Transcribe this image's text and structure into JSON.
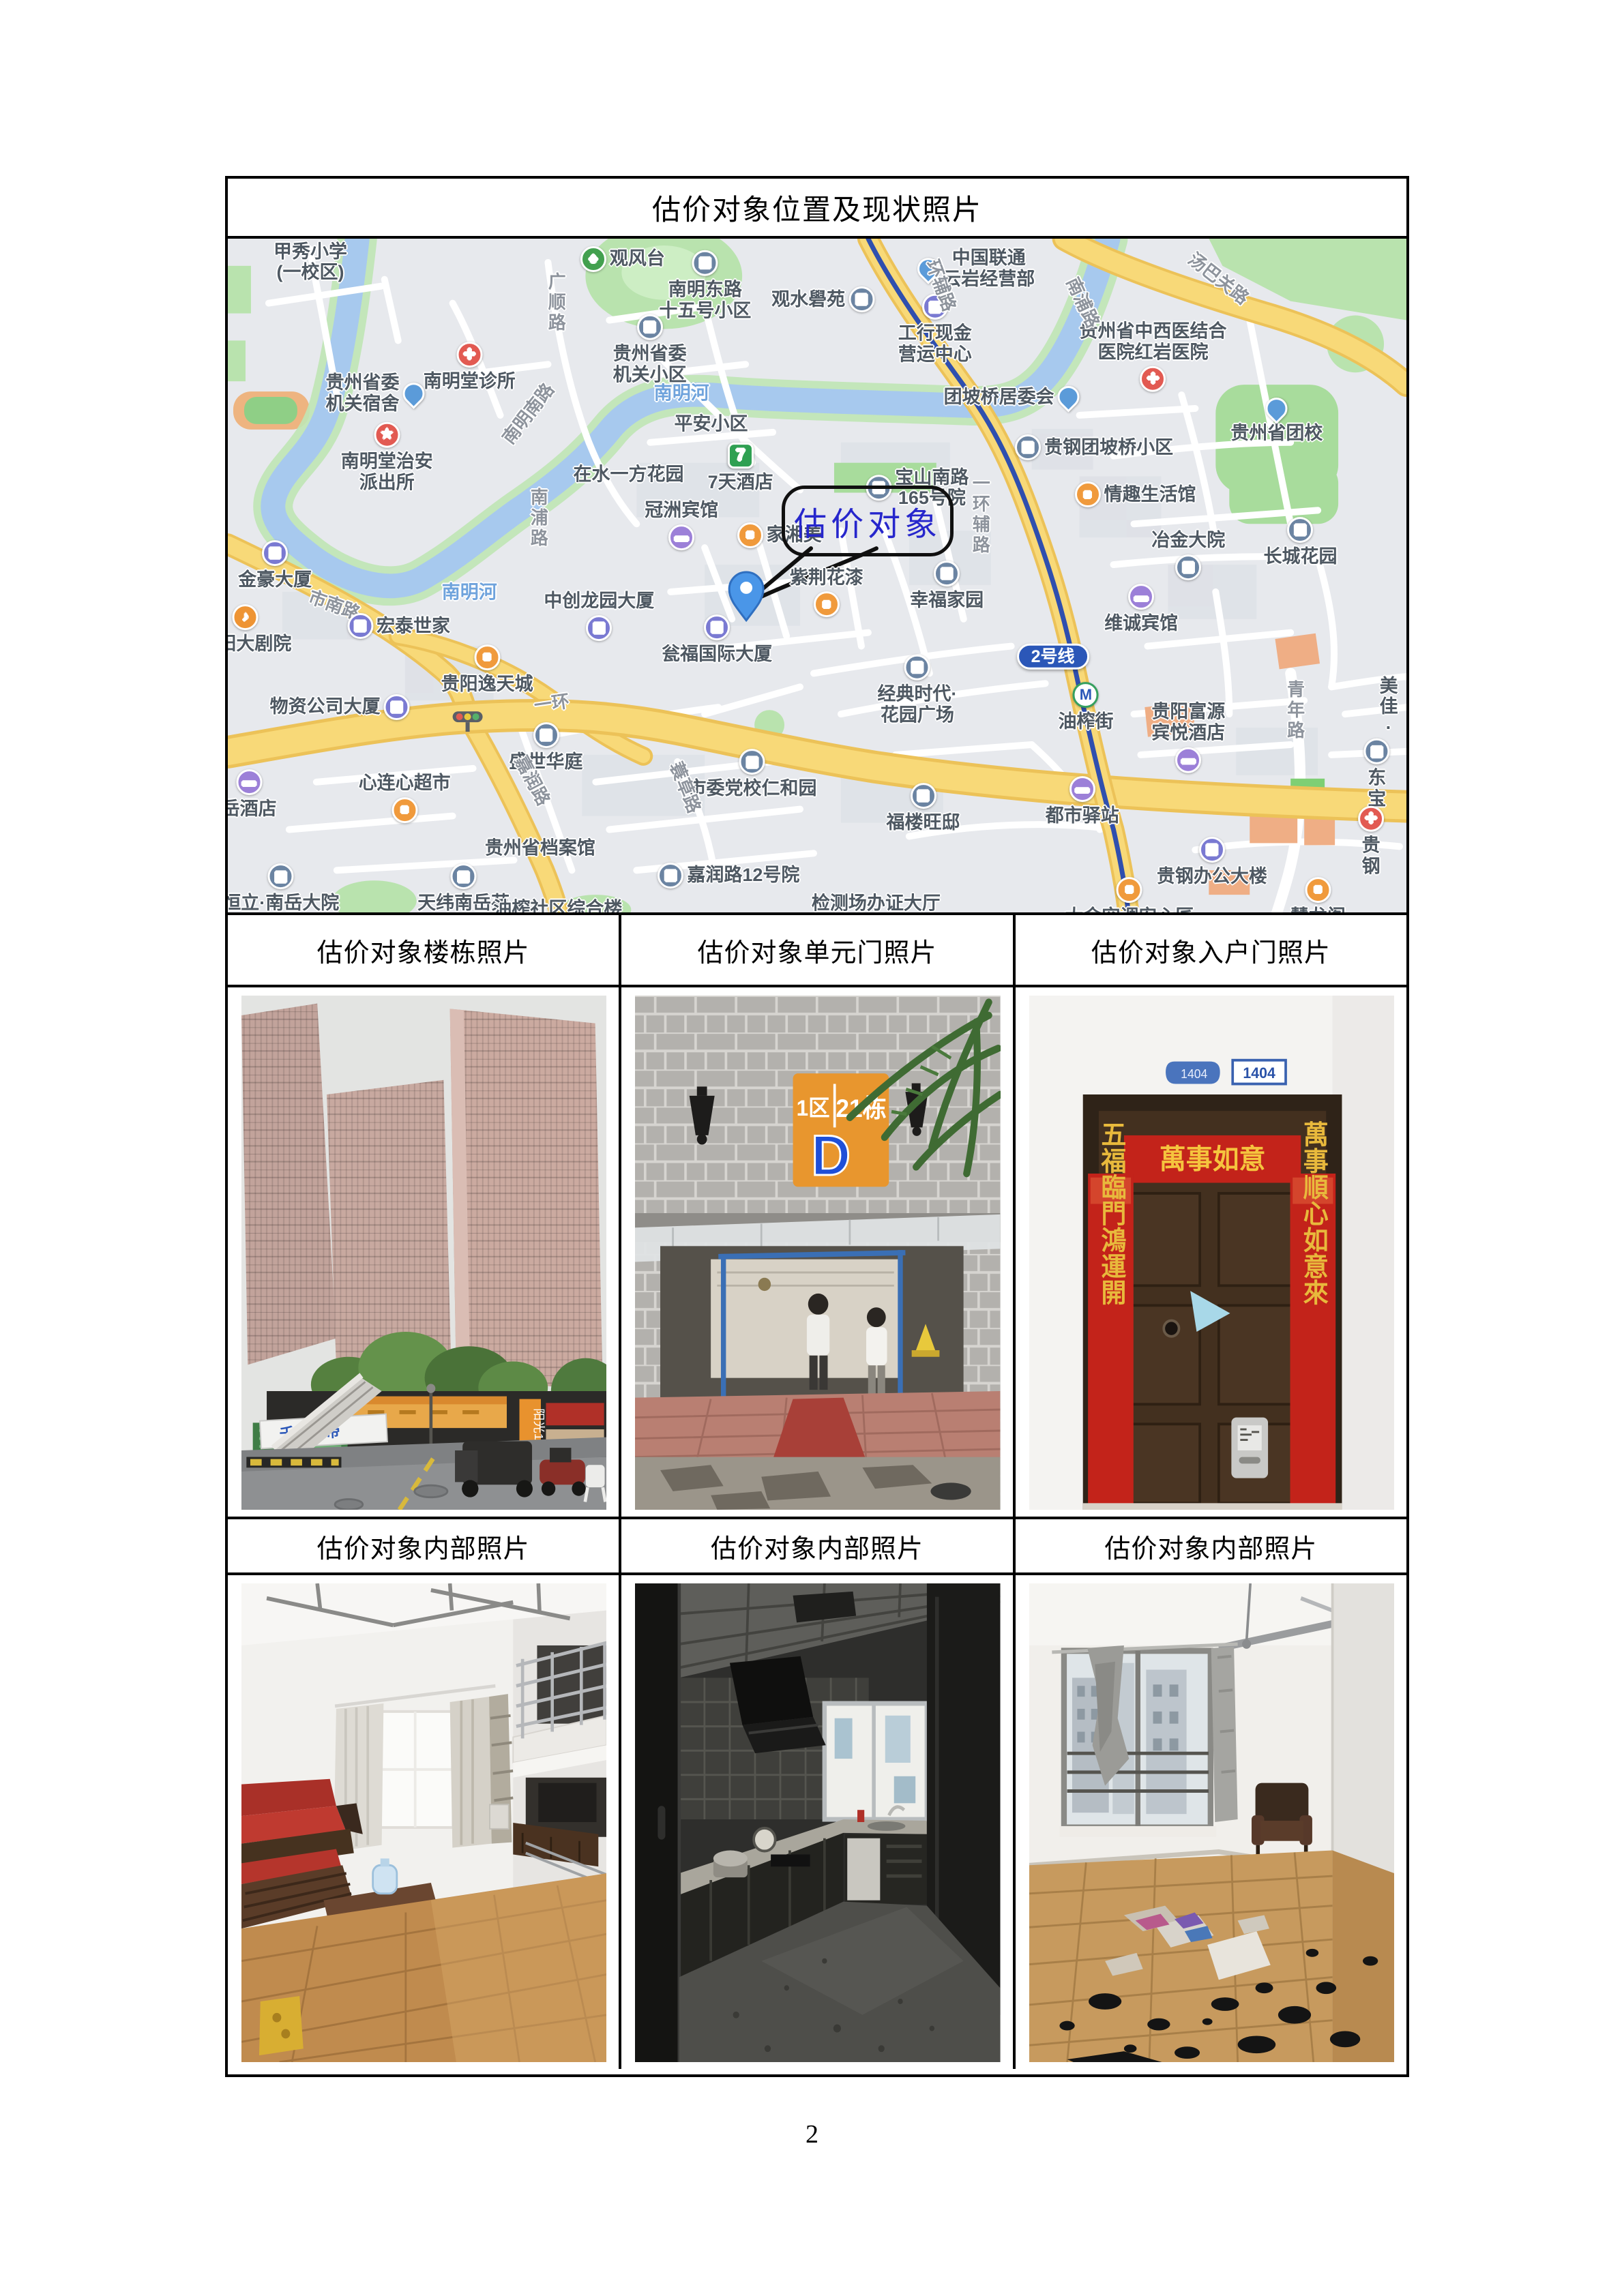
{
  "page": {
    "number": "2"
  },
  "table": {
    "title": "估价对象位置及现状照片",
    "captions_row1": [
      "估价对象楼栋照片",
      "估价对象单元门照片",
      "估价对象入户门照片"
    ],
    "captions_row2": [
      "估价对象内部照片",
      "估价对象内部照片",
      "估价对象内部照片"
    ]
  },
  "map": {
    "target_label": "估价对象",
    "colors": {
      "water": "#a7c9ee",
      "park": "#b9e3ae",
      "road_major": "#f8d978",
      "metro_line": "#2f4fae",
      "target_text": "#2626cc"
    },
    "labels": [
      {
        "t": "甲秀小学\n(一校区)",
        "x": 7,
        "y": 3.5
      },
      {
        "t": "广顺路",
        "x": 27.8,
        "y": 9.5,
        "cls": "road",
        "vert": true
      },
      {
        "t": "南明东路\n十五号小区",
        "x": 40.5,
        "y": 7,
        "icon": "building",
        "ip": "t"
      },
      {
        "t": "观风台",
        "x": 33.5,
        "y": 3,
        "icon": "park",
        "ip": "l"
      },
      {
        "t": "观水礐苑",
        "x": 50.5,
        "y": 9,
        "icon": "building",
        "ip": "r"
      },
      {
        "t": "中国联通\n云岩经营部",
        "x": 63.5,
        "y": 4.5,
        "icon": "pin",
        "ip": "l"
      },
      {
        "t": "工行现金\n营运中心",
        "x": 60,
        "y": 13.5,
        "icon": "office",
        "ip": "t"
      },
      {
        "t": "贵州省委\n机关小区",
        "x": 35.8,
        "y": 16.5,
        "icon": "building",
        "ip": "t"
      },
      {
        "t": "南明堂诊所",
        "x": 20.5,
        "y": 19,
        "icon": "hospital",
        "ip": "t"
      },
      {
        "t": "贵州省委\n机关宿舍",
        "x": 12.5,
        "y": 23,
        "icon": "pin",
        "ip": "r"
      },
      {
        "t": "南明堂治安\n派出所",
        "x": 13.5,
        "y": 32.5,
        "icon": "police",
        "ip": "t"
      },
      {
        "t": "南明南路",
        "x": 25.5,
        "y": 26,
        "cls": "road",
        "rot": -52
      },
      {
        "t": "南明河",
        "x": 38.5,
        "y": 23,
        "cls": "water"
      },
      {
        "t": "平安小区",
        "x": 41,
        "y": 27.5
      },
      {
        "t": "7天酒店",
        "x": 43.5,
        "y": 34,
        "icon": "seven",
        "ip": "t"
      },
      {
        "t": "团坡桥居委会",
        "x": 66.5,
        "y": 23.5,
        "icon": "pin",
        "ip": "r"
      },
      {
        "t": "贵钢团坡桥小区",
        "x": 73.5,
        "y": 31,
        "icon": "building",
        "ip": "l"
      },
      {
        "t": "贵州省中西医结合\n医院红岩医院",
        "x": 78.5,
        "y": 17.5,
        "icon": "hospital",
        "ip": "b"
      },
      {
        "t": "贵州省团校",
        "x": 89,
        "y": 27,
        "icon": "pin",
        "ip": "t"
      },
      {
        "t": "汤巴关路",
        "x": 84,
        "y": 6,
        "cls": "road",
        "rot": 38
      },
      {
        "t": "南浦路",
        "x": 72.5,
        "y": 9.5,
        "cls": "road",
        "rot": 65
      },
      {
        "t": "情趣生活馆",
        "x": 77,
        "y": 38,
        "icon": "shop",
        "ip": "l"
      },
      {
        "t": "在水一方花园",
        "x": 34,
        "y": 35
      },
      {
        "t": "冠洲宾馆",
        "x": 38.5,
        "y": 42.5,
        "icon": "hotel",
        "ip": "b"
      },
      {
        "t": "南浦路",
        "x": 26.3,
        "y": 41.5,
        "cls": "road",
        "vert": true
      },
      {
        "t": "家湘美",
        "x": 46.8,
        "y": 44,
        "icon": "shop",
        "ip": "l"
      },
      {
        "t": "宝山南路\n165号院",
        "x": 58.5,
        "y": 37,
        "icon": "building",
        "ip": "l"
      },
      {
        "t": "紫荆花漆",
        "x": 50.8,
        "y": 52.5,
        "icon": "shop",
        "ip": "b"
      },
      {
        "t": "幸福家园",
        "x": 61,
        "y": 51.5,
        "icon": "building",
        "ip": "t"
      },
      {
        "t": "冶金大院",
        "x": 81.5,
        "y": 47,
        "icon": "building",
        "ip": "b"
      },
      {
        "t": "长城花园",
        "x": 91,
        "y": 45,
        "icon": "building",
        "ip": "t"
      },
      {
        "t": "维诚宾馆",
        "x": 77.5,
        "y": 55,
        "icon": "hotel",
        "ip": "t"
      },
      {
        "t": "南明河",
        "x": 20.5,
        "y": 52.5,
        "cls": "water"
      },
      {
        "t": "市南路",
        "x": 9,
        "y": 54.5,
        "cls": "road",
        "rot": 20
      },
      {
        "t": "金豪大厦",
        "x": 4,
        "y": 48.5,
        "icon": "office",
        "ip": "t"
      },
      {
        "t": "宏泰世家",
        "x": 14.5,
        "y": 57.5,
        "icon": "office",
        "ip": "l"
      },
      {
        "t": "贵阳大剧院",
        "x": 1.5,
        "y": 58,
        "icon": "music",
        "ip": "t"
      },
      {
        "t": "中创龙园大厦",
        "x": 31.5,
        "y": 56,
        "icon": "office",
        "ip": "b"
      },
      {
        "t": "瓮福国际大厦",
        "x": 41.5,
        "y": 59.5,
        "icon": "office",
        "ip": "t"
      },
      {
        "t": "贵阳逸天城",
        "x": 22,
        "y": 64,
        "icon": "shop",
        "ip": "t"
      },
      {
        "t": "经典时代·\n花园广场",
        "x": 58.5,
        "y": 67,
        "icon": "building",
        "ip": "t"
      },
      {
        "t": "2号线",
        "x": 70,
        "y": 62,
        "cls": "badge"
      },
      {
        "t": "油榨街",
        "x": 72.8,
        "y": 69.5,
        "icon": "metro",
        "ip": "t"
      },
      {
        "t": "一环",
        "x": 27.5,
        "y": 69,
        "cls": "road",
        "rot": -8
      },
      {
        "t": "盛世华庭",
        "x": 27,
        "y": 75.5,
        "icon": "building",
        "ip": "t"
      },
      {
        "t": "嘉润路",
        "x": 25.8,
        "y": 80.5,
        "cls": "road",
        "rot": 62
      },
      {
        "t": "心连心超市",
        "x": 15,
        "y": 83,
        "icon": "cart",
        "ip": "b"
      },
      {
        "t": "岳酒店",
        "x": 1.8,
        "y": 82.5,
        "icon": "hotel",
        "ip": "t"
      },
      {
        "t": "物资公司大厦",
        "x": 9.5,
        "y": 69.5,
        "icon": "office",
        "ip": "r"
      },
      {
        "t": "市委党校仁和园",
        "x": 44.5,
        "y": 79.5,
        "icon": "building",
        "ip": "t"
      },
      {
        "t": "蓑草路",
        "x": 38.8,
        "y": 81.5,
        "cls": "road",
        "rot": 68
      },
      {
        "t": "嘉润路12号院",
        "x": 42.5,
        "y": 94.5,
        "icon": "building",
        "ip": "l"
      },
      {
        "t": "贵州省档案馆",
        "x": 26.5,
        "y": 90.5
      },
      {
        "t": "恒立·南岳大院",
        "x": 4.5,
        "y": 96.5,
        "icon": "building",
        "ip": "t"
      },
      {
        "t": "天纬南岳苑",
        "x": 20,
        "y": 96.5,
        "icon": "building",
        "ip": "t"
      },
      {
        "t": "检测场办证大厅",
        "x": 55,
        "y": 98.7
      },
      {
        "t": "福楼旺邸",
        "x": 59,
        "y": 84.5,
        "icon": "building",
        "ip": "t"
      },
      {
        "t": "都市驿站",
        "x": 72.5,
        "y": 83.5,
        "icon": "hotel",
        "ip": "t"
      },
      {
        "t": "贵阳富源\n宾悦酒店",
        "x": 81.5,
        "y": 74,
        "icon": "hotel",
        "ip": "b"
      },
      {
        "t": "贵钢办公大楼",
        "x": 83.5,
        "y": 92.5,
        "icon": "office",
        "ip": "t"
      },
      {
        "t": "大金空调安心匠",
        "x": 76.5,
        "y": 98.5,
        "icon": "shop",
        "ip": "t"
      },
      {
        "t": "慧龙阁",
        "x": 92.5,
        "y": 98.5,
        "icon": "shop",
        "ip": "t"
      },
      {
        "t": "青年路",
        "x": 90.5,
        "y": 70,
        "cls": "road",
        "vert": true
      },
      {
        "t": "美佳·",
        "x": 98.5,
        "y": 69.5
      },
      {
        "t": "东宝",
        "x": 97.5,
        "y": 79.5,
        "icon": "building",
        "ip": "t"
      },
      {
        "t": "贵钢",
        "x": 97,
        "y": 89.5,
        "icon": "hospital",
        "ip": "t"
      },
      {
        "t": "一环辅路",
        "x": 63.8,
        "y": 41,
        "cls": "road",
        "vert": true
      },
      {
        "t": "环辅路",
        "x": 60.5,
        "y": 7,
        "cls": "road",
        "rot": 70
      },
      {
        "t": "油榨社区综合楼",
        "x": 28,
        "y": 99.5
      }
    ]
  },
  "photos": {
    "building": {
      "vertical_banner": "阳光100幼儿园",
      "ad_banner": "千兆宽带"
    },
    "unit_door": {
      "plaque_zone": "1区",
      "plaque_building": "21栋",
      "plaque_unit": "D"
    },
    "entry_door": {
      "plaque_left_no": "1404",
      "plaque_right_no": "1404",
      "banner": "萬事如意",
      "couplet_left": "五福臨門鴻運開",
      "couplet_right": "萬事順心如意來"
    }
  }
}
